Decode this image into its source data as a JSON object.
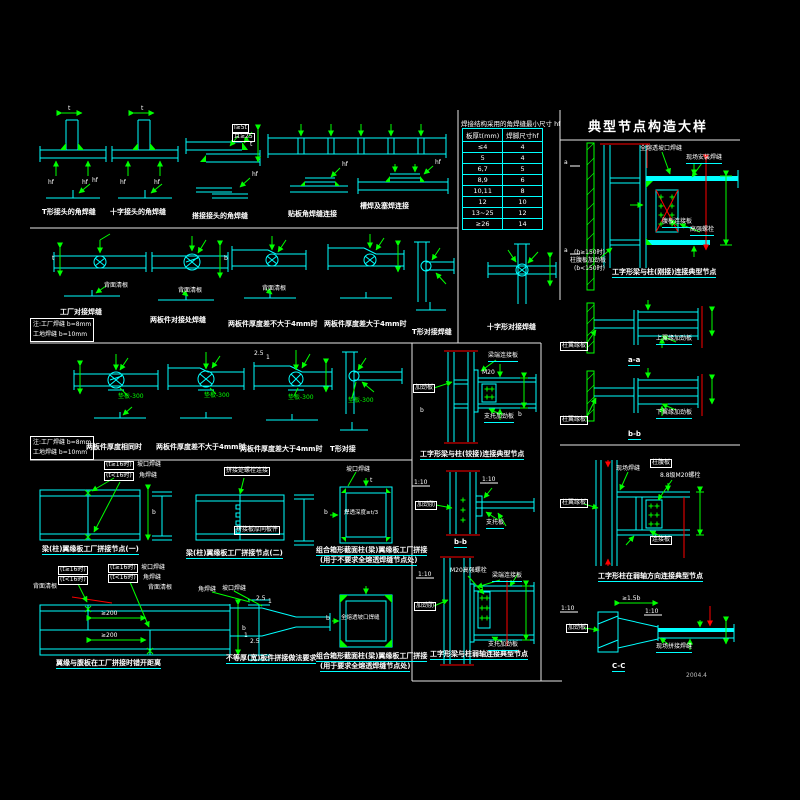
{
  "sheet": {
    "title": "典型节点构造大样",
    "stamp": "2004.4"
  },
  "table": {
    "title": "焊接结构采用的角焊缝最小尺寸 hf",
    "headers": [
      "板厚t(mm)",
      "焊脚尺寸hf"
    ],
    "rows": [
      [
        "≤4",
        "4"
      ],
      [
        "5",
        "4"
      ],
      [
        "6,7",
        "5"
      ],
      [
        "8,9",
        "6"
      ],
      [
        "10,11",
        "8"
      ],
      [
        "12",
        "10"
      ],
      [
        "13~25",
        "12"
      ],
      [
        "≥26",
        "14"
      ]
    ]
  },
  "legend": {
    "l1": "注:工厂焊缝 b=8mm",
    "l2": "工地焊缝 b=10mm"
  },
  "captions": {
    "r1c1": "T形接头的角焊缝",
    "r1c2": "十字接头的角焊缝",
    "r1c3": "搭接接头的角焊缝",
    "r1c4": "贴板角焊缝连接",
    "r1c5": "槽焊及塞焊连接",
    "r2c1": "工厂对接焊缝",
    "r2c2": "两板件对接处焊缝",
    "r2c3": "两板件厚度差不大于4mm时",
    "r2c4": "两板件厚度差大于4mm时",
    "r2c5": "T形对接焊缝",
    "r2c6": "十字形对接焊缝",
    "r3c1": "两板件厚度相同时",
    "r3c2": "两板件厚度差不大于4mm时",
    "r3c3": "两板件厚度差大于4mm时",
    "r3c4": "T形对接",
    "d1": "梁(柱)翼缘板工厂拼接节点(一)",
    "d3": "梁(柱)翼缘板工厂拼接节点(二)",
    "d5a": "组合箱形截面柱(梁)翼缘板工厂拼接",
    "d5b": "(用于不要求全熔透焊缝节点处)",
    "e1": "翼缘与腹板在工厂拼接时错开距离",
    "e3": "不等厚(宽)板件拼接做法要求",
    "e4a": "组合箱形截面柱(梁)翼缘板工厂拼接",
    "e4b": "(用于要求全熔透焊缝节点处)",
    "f1": "工字形梁与柱(铰接)连接典型节点",
    "f3": "工字形梁与柱弱轴连接典型节点",
    "g1": "工字形梁与柱(刚接)连接典型节点",
    "g4": "工字形柱在弱轴方向连接典型节点",
    "aa": "a-a",
    "bb": "b-b",
    "bsec": "b-b",
    "cc": "C-C"
  },
  "labels": {
    "beiqing": "背面清根",
    "pad": "垫板-300",
    "t16": "(t≥16时)",
    "lt16": "(t<16时)",
    "slot": "坡口焊缝",
    "jiao": "角焊缝",
    "lap1": "l≥5t",
    "lap2": "且≥25",
    "d3a": "拼接处螺栓连接",
    "d3b": "拼接板厚同板件",
    "d5in": "焊透深度≥t/3",
    "e4in": "全熔透坡口焊缝",
    "stiff": "加劲板",
    "stiffrib": "加劲肋",
    "endplate": "梁端连接板",
    "seat": "支托加劲板",
    "seat2": "支托板",
    "m20": "M20高强螺栓",
    "m20b": "8.8级M20螺栓",
    "fullweld": "全熔透坡口焊缝",
    "siteweld": "现场安装焊缝",
    "siteweld2": "现场焊缝",
    "webplate": "腹板连接板",
    "hsbolt": "高强螺栓",
    "b150a": "(b≥150时)",
    "b150b": "柱腹板加劲板",
    "b150c": "(b<150时)",
    "colflange": "柱翼缘板",
    "topstiff": "上翼缘加劲板",
    "botstiff": "下翼缘加劲板",
    "colweb": "柱腹板",
    "connplate": "连接板",
    "splice": "现场拼接焊缝"
  },
  "dims": {
    "t": "t",
    "b": "b",
    "hf": "hf",
    "ge200": "≥200",
    "s25": "2.5",
    "s1": "1",
    "s110": "1:10",
    "ge15b": "≥1.5b",
    "a": "a",
    "m20": "M20"
  },
  "colors": {
    "line": "#00ffff",
    "weld": "#00ff00",
    "accent": "#ff0000",
    "text": "#ffffff",
    "background": "#000000"
  }
}
